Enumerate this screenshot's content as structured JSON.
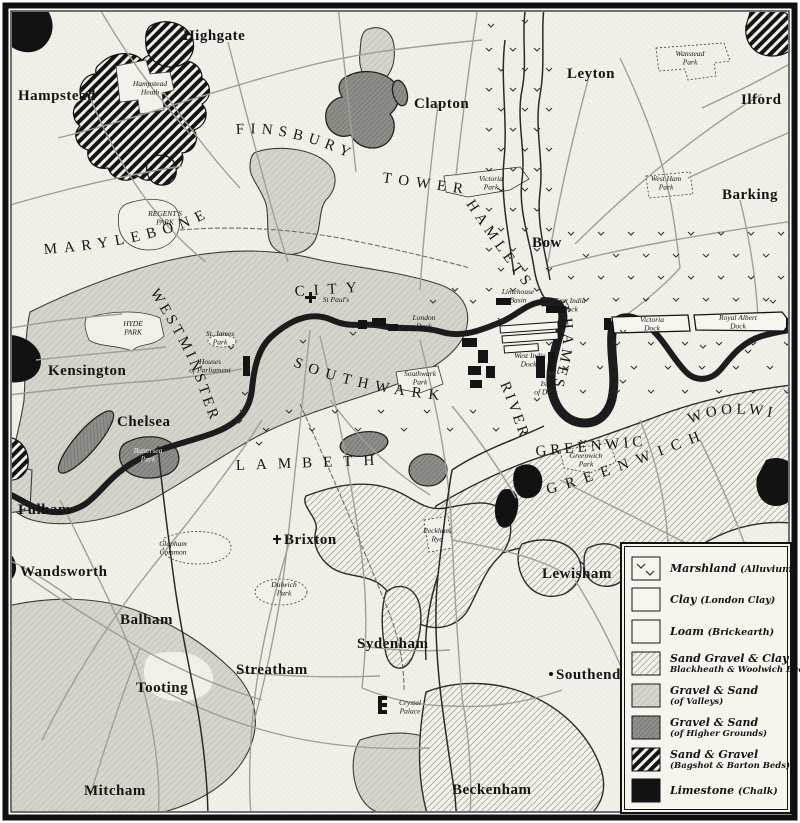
{
  "map_title": "Geological map of London districts",
  "colors": {
    "paper": "#f1efe7",
    "gravel_valleys": "#d7d5cb",
    "gravel_higher": "#8f8f89",
    "hatch_light_bg": "#f2f0e8",
    "hatch_dark": "#141414",
    "limestone": "#121212",
    "ink": "#151515",
    "river": "#1c1c1c",
    "road": "#a19f95"
  },
  "legend": {
    "items": [
      {
        "label": "Marshland",
        "paren": "(Alluvium)",
        "sub": "",
        "swatch": "marsh"
      },
      {
        "label": "Clay",
        "paren": "(London Clay)",
        "sub": "",
        "swatch": "clay"
      },
      {
        "label": "Loam",
        "paren": "(Brickearth)",
        "sub": "",
        "swatch": "loam"
      },
      {
        "label": "Sand Gravel & Clay",
        "paren": "",
        "sub": "Blackheath & Woolwich Beds",
        "swatch": "hatch-light"
      },
      {
        "label": "Gravel & Sand",
        "paren": "",
        "sub": "(of Valleys)",
        "swatch": "gravel-valleys"
      },
      {
        "label": "Gravel & Sand",
        "paren": "",
        "sub": "(of Higher Grounds)",
        "swatch": "gravel-higher"
      },
      {
        "label": "Sand & Gravel",
        "paren": "",
        "sub": "(Bagshot & Barton Beds)",
        "swatch": "hatch-dark"
      },
      {
        "label": "Limestone",
        "paren": "(Chalk)",
        "sub": "",
        "swatch": "black"
      }
    ]
  },
  "labels": {
    "towns": [
      {
        "text": "Highgate",
        "x": 183,
        "y": 40
      },
      {
        "text": "Hampstead",
        "x": 18,
        "y": 100
      },
      {
        "text": "Leyton",
        "x": 567,
        "y": 78
      },
      {
        "text": "Ilford",
        "x": 741,
        "y": 104
      },
      {
        "text": "Barking",
        "x": 722,
        "y": 199
      },
      {
        "text": "Clapton",
        "x": 414,
        "y": 108
      },
      {
        "text": "Bow",
        "x": 532,
        "y": 247
      },
      {
        "text": "Kensington",
        "x": 48,
        "y": 375
      },
      {
        "text": "Chelsea",
        "x": 117,
        "y": 426
      },
      {
        "text": "Fulham",
        "x": 18,
        "y": 514
      },
      {
        "text": "Wandsworth",
        "x": 20,
        "y": 576
      },
      {
        "text": "Brixton",
        "x": 284,
        "y": 544
      },
      {
        "text": "Lewisham",
        "x": 542,
        "y": 578
      },
      {
        "text": "Balham",
        "x": 120,
        "y": 624
      },
      {
        "text": "Sydenham",
        "x": 357,
        "y": 648
      },
      {
        "text": "Streatham",
        "x": 236,
        "y": 674
      },
      {
        "text": "Southend",
        "x": 556,
        "y": 679
      },
      {
        "text": "Tooting",
        "x": 136,
        "y": 692
      },
      {
        "text": "Mitcham",
        "x": 84,
        "y": 795
      },
      {
        "text": "Beckenham",
        "x": 452,
        "y": 794
      }
    ],
    "districts": [
      {
        "id": "marylebone",
        "text": "MARYLEBONE",
        "size": 16,
        "ls": 7
      },
      {
        "id": "finsbury",
        "text": "FINSBURY",
        "size": 14,
        "ls": 6
      },
      {
        "id": "tower",
        "text": "TOWER",
        "size": 14,
        "ls": 7
      },
      {
        "id": "hamlets",
        "text": "HAMLETS",
        "size": 14,
        "ls": 5
      },
      {
        "id": "westminster",
        "text": "WESTMINSTER",
        "size": 14,
        "ls": 3.5
      },
      {
        "id": "city",
        "text": "CITY",
        "size": 16,
        "ls": 9
      },
      {
        "id": "southwark",
        "text": "SOUTHWARK",
        "size": 16,
        "ls": 7
      },
      {
        "id": "lambeth",
        "text": "LAMBETH",
        "size": 15,
        "ls": 11
      },
      {
        "id": "greenwich-d",
        "text": "GREENWICH",
        "size": 15,
        "ls": 9
      },
      {
        "id": "woolwich",
        "text": "WOOLWICH",
        "size": 13,
        "ls": 4
      },
      {
        "id": "greenwich-t",
        "text": "GREENWICH",
        "size": 11,
        "ls": 4
      },
      {
        "id": "river",
        "text": "RIVER",
        "size": 11,
        "ls": 3
      },
      {
        "id": "thames",
        "text": "THAMES",
        "size": 11,
        "ls": 4
      }
    ],
    "places": [
      {
        "text": "Hampstead",
        "line2": "Heath",
        "x": 150,
        "y": 86
      },
      {
        "text": "Wanstead",
        "line2": "Park",
        "x": 690,
        "y": 56
      },
      {
        "text": "West Ham",
        "line2": "Park",
        "x": 666,
        "y": 181
      },
      {
        "text": "Victoria",
        "line2": "Park",
        "x": 491,
        "y": 181
      },
      {
        "text": "REGENT'S",
        "line2": "PARK",
        "x": 165,
        "y": 216
      },
      {
        "text": "HYDE",
        "line2": "PARK",
        "x": 133,
        "y": 326
      },
      {
        "text": "St. James",
        "line2": "Park",
        "x": 220,
        "y": 336
      },
      {
        "text": "Houses",
        "line2": "of Parliament",
        "x": 210,
        "y": 364
      },
      {
        "text": "Battersea",
        "line2": "Park",
        "x": 148,
        "y": 453,
        "cls": "place-light"
      },
      {
        "text": "Clapham",
        "line2": "Common",
        "x": 173,
        "y": 546
      },
      {
        "text": "Southwark",
        "line2": "Park",
        "x": 420,
        "y": 376
      },
      {
        "text": "Isle",
        "line2": "of Dogs",
        "x": 546,
        "y": 386
      },
      {
        "text": "Greenwich",
        "line2": "Park",
        "x": 586,
        "y": 458
      },
      {
        "text": "Peckham",
        "line2": "Rye",
        "x": 437,
        "y": 533
      },
      {
        "text": "Dulwich",
        "line2": "Park",
        "x": 284,
        "y": 587
      },
      {
        "text": "Crystal",
        "line2": "Palace",
        "x": 410,
        "y": 705
      },
      {
        "text": "Limehouse",
        "line2": "Basin",
        "x": 518,
        "y": 294
      },
      {
        "text": "East India",
        "line2": "Dock",
        "x": 570,
        "y": 303
      },
      {
        "text": "Victoria",
        "line2": "Dock",
        "x": 652,
        "y": 322
      },
      {
        "text": "Royal Albert",
        "line2": "Dock",
        "x": 738,
        "y": 320
      },
      {
        "text": "West India",
        "line2": "Docks",
        "x": 530,
        "y": 358
      },
      {
        "text": "London",
        "line2": "Dock",
        "x": 424,
        "y": 320
      },
      {
        "text": "St Paul's",
        "line2": "",
        "x": 336,
        "y": 302
      }
    ]
  }
}
